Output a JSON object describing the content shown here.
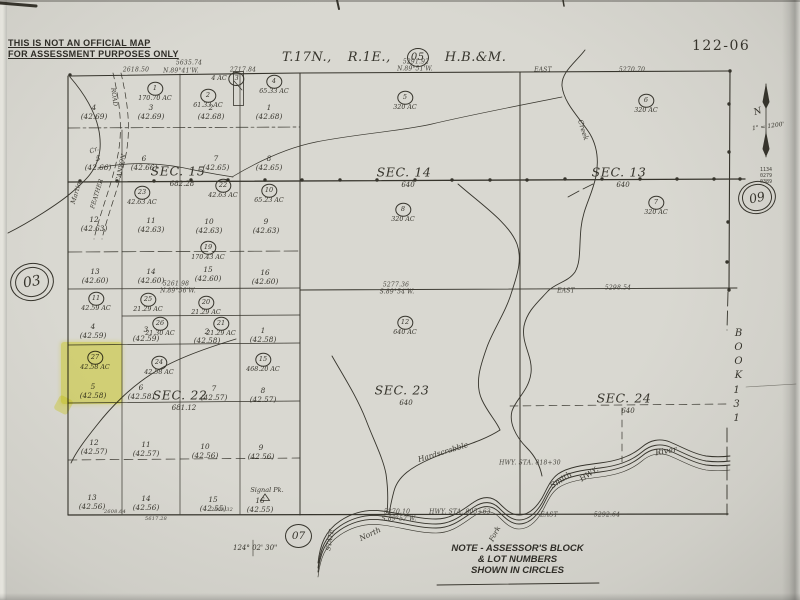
{
  "ink_color": "#36342c",
  "paper_color": "#d7d6cf",
  "highlight_color": "#f0ed3e",
  "page": {
    "map_number": "122-06",
    "disclaimer": [
      "THIS IS NOT AN OFFICIAL MAP",
      "FOR ASSESSMENT PURPOSES ONLY"
    ],
    "title": {
      "township": "T.17N.,",
      "range": "R.1E.,",
      "code": "05",
      "meridian": "H.B.&M."
    },
    "note": [
      "NOTE - ASSESSOR'S BLOCK",
      "& LOT NUMBERS",
      "SHOWN IN CIRCLES"
    ],
    "longitude": "124° 02' 30\"",
    "scale": "1\" = 1200'",
    "north": "N",
    "ref_left": "03",
    "ref_right": "09",
    "ref_bottom": "07",
    "stack": [
      "1134",
      "0279",
      "0389"
    ],
    "book_word": "BOOK",
    "book_number": "131"
  },
  "sections": [
    {
      "label": "SEC. 15",
      "sub": "682.28",
      "x": 178,
      "y": 171
    },
    {
      "label": "SEC. 14",
      "sub": "640",
      "x": 404,
      "y": 172
    },
    {
      "label": "SEC. 13",
      "sub": "640",
      "x": 619,
      "y": 172
    },
    {
      "label": "SEC. 22",
      "sub": "681.12",
      "x": 180,
      "y": 395
    },
    {
      "label": "SEC. 23",
      "sub": "640",
      "x": 402,
      "y": 390
    },
    {
      "label": "SEC. 24",
      "sub": "640",
      "x": 624,
      "y": 398
    }
  ],
  "lots": [
    {
      "n": "1",
      "ac": "170.70 AC",
      "x": 155,
      "y": 89
    },
    {
      "n": "2",
      "ac": "61.33 AC",
      "x": 208,
      "y": 96
    },
    {
      "n": "3",
      "ac": "4 AC",
      "x": 228,
      "y": 79,
      "side": true
    },
    {
      "n": "4",
      "ac": "65.33 AC",
      "x": 274,
      "y": 82
    },
    {
      "n": "5",
      "ac": "320 AC",
      "x": 405,
      "y": 98
    },
    {
      "n": "6",
      "ac": "320 AC",
      "x": 646,
      "y": 101
    },
    {
      "n": "7",
      "ac": "320 AC",
      "x": 656,
      "y": 203
    },
    {
      "n": "8",
      "ac": "320 AC",
      "x": 403,
      "y": 210
    },
    {
      "n": "23",
      "ac": "42.63 AC",
      "x": 142,
      "y": 193
    },
    {
      "n": "22",
      "ac": "42.63 AC",
      "x": 223,
      "y": 186
    },
    {
      "n": "10",
      "ac": "65.23 AC",
      "x": 269,
      "y": 191
    },
    {
      "n": "19",
      "ac": "170.43 AC",
      "x": 208,
      "y": 248
    },
    {
      "n": "11",
      "ac": "42.59 AC",
      "x": 96,
      "y": 299
    },
    {
      "n": "25",
      "ac": "21.29 AC",
      "x": 148,
      "y": 300
    },
    {
      "n": "20",
      "ac": "21.29 AC",
      "x": 206,
      "y": 303
    },
    {
      "n": "26",
      "ac": "21.30 AC",
      "x": 160,
      "y": 324
    },
    {
      "n": "21",
      "ac": "21.29 AC",
      "x": 221,
      "y": 324
    },
    {
      "n": "27",
      "ac": "42.58 AC",
      "x": 95,
      "y": 358
    },
    {
      "n": "24",
      "ac": "42.58 AC",
      "x": 159,
      "y": 363
    },
    {
      "n": "15",
      "ac": "468.20 AC",
      "x": 263,
      "y": 360
    },
    {
      "n": "12",
      "ac": "640 AC",
      "x": 405,
      "y": 323
    }
  ],
  "parcels": [
    {
      "n": "4",
      "v": "(42.69)",
      "x": 94,
      "y": 112
    },
    {
      "n": "3",
      "v": "(42.69)",
      "x": 151,
      "y": 112
    },
    {
      "n": "2",
      "v": "(42.68)",
      "x": 211,
      "y": 112
    },
    {
      "n": "1",
      "v": "(42.68)",
      "x": 269,
      "y": 112
    },
    {
      "n": "5",
      "v": "(42.66)",
      "x": 98,
      "y": 163
    },
    {
      "n": "6",
      "v": "(42.66)",
      "x": 144,
      "y": 163
    },
    {
      "n": "7",
      "v": "(42.65)",
      "x": 216,
      "y": 163
    },
    {
      "n": "8",
      "v": "(42.65)",
      "x": 269,
      "y": 163
    },
    {
      "n": "12",
      "v": "(42.63)",
      "x": 94,
      "y": 224
    },
    {
      "n": "11",
      "v": "(42.63)",
      "x": 151,
      "y": 225
    },
    {
      "n": "10",
      "v": "(42.63)",
      "x": 209,
      "y": 226
    },
    {
      "n": "9",
      "v": "(42.63)",
      "x": 266,
      "y": 226
    },
    {
      "n": "13",
      "v": "(42.60)",
      "x": 95,
      "y": 276
    },
    {
      "n": "14",
      "v": "(42.60)",
      "x": 151,
      "y": 276
    },
    {
      "n": "15",
      "v": "(42.60)",
      "x": 208,
      "y": 274
    },
    {
      "n": "16",
      "v": "(42.60)",
      "x": 265,
      "y": 277
    },
    {
      "n": "4",
      "v": "(42.59)",
      "x": 93,
      "y": 331
    },
    {
      "n": "3",
      "v": "(42.59)",
      "x": 146,
      "y": 334
    },
    {
      "n": "2",
      "v": "(42.58)",
      "x": 207,
      "y": 336
    },
    {
      "n": "1",
      "v": "(42.58)",
      "x": 263,
      "y": 335
    },
    {
      "n": "5",
      "v": "(42.58)",
      "x": 93,
      "y": 391
    },
    {
      "n": "6",
      "v": "(42.58)",
      "x": 141,
      "y": 392
    },
    {
      "n": "7",
      "v": "(42.57)",
      "x": 214,
      "y": 393
    },
    {
      "n": "8",
      "v": "(42.57)",
      "x": 263,
      "y": 395
    },
    {
      "n": "12",
      "v": "(42.57)",
      "x": 94,
      "y": 447
    },
    {
      "n": "11",
      "v": "(42.57)",
      "x": 146,
      "y": 449
    },
    {
      "n": "10",
      "v": "(42.56)",
      "x": 205,
      "y": 451
    },
    {
      "n": "9",
      "v": "(42.56)",
      "x": 261,
      "y": 452
    },
    {
      "n": "13",
      "v": "(42.56)",
      "x": 92,
      "y": 502
    },
    {
      "n": "14",
      "v": "(42.56)",
      "x": 146,
      "y": 503
    },
    {
      "n": "15",
      "v": "(42.55)",
      "x": 213,
      "y": 504
    },
    {
      "n": "16",
      "v": "(42.55)",
      "x": 260,
      "y": 505
    }
  ],
  "survey_text": [
    {
      "t": "2618.50",
      "x": 136,
      "y": 70
    },
    {
      "t": "5635.74",
      "x": 189,
      "y": 63
    },
    {
      "t": "N.89°41'W.",
      "x": 181,
      "y": 71
    },
    {
      "t": "2717.84",
      "x": 243,
      "y": 70
    },
    {
      "t": "5291.92",
      "x": 416,
      "y": 62
    },
    {
      "t": "N.89°51'W.",
      "x": 415,
      "y": 69
    },
    {
      "t": "EAST",
      "x": 543,
      "y": 70
    },
    {
      "t": "5270.70",
      "x": 632,
      "y": 70
    },
    {
      "t": "5261.98",
      "x": 176,
      "y": 284
    },
    {
      "t": "N.89°56'W.",
      "x": 178,
      "y": 291
    },
    {
      "t": "5277.36",
      "x": 396,
      "y": 285
    },
    {
      "t": "S.89°54'W.",
      "x": 397,
      "y": 292
    },
    {
      "t": "EAST",
      "x": 566,
      "y": 291
    },
    {
      "t": "5298.54",
      "x": 618,
      "y": 288
    },
    {
      "t": "5270.10",
      "x": 397,
      "y": 512
    },
    {
      "t": "S.89°52'W.",
      "x": 399,
      "y": 519
    },
    {
      "t": "HWY. STA. 805+63",
      "x": 460,
      "y": 512
    },
    {
      "t": "HWY. STA. 818+30",
      "x": 530,
      "y": 463
    },
    {
      "t": "EAST",
      "x": 549,
      "y": 515
    },
    {
      "t": "5292.64",
      "x": 607,
      "y": 515
    },
    {
      "t": "2608.64",
      "x": 115,
      "y": 512,
      "s": 5
    },
    {
      "t": "5617.28",
      "x": 156,
      "y": 519,
      "s": 5
    },
    {
      "t": "2608.32",
      "x": 222,
      "y": 510,
      "s": 5
    }
  ],
  "features": [
    {
      "t": "Creek",
      "x": 583,
      "y": 130,
      "r": 73,
      "s": 7
    },
    {
      "t": "ROAD",
      "x": 114,
      "y": 97,
      "r": 83,
      "s": 6
    },
    {
      "t": "CANYON",
      "x": 121,
      "y": 168,
      "r": -78,
      "s": 6
    },
    {
      "t": "Cr.",
      "x": 94,
      "y": 150,
      "r": -25,
      "s": 6.5
    },
    {
      "t": "Martin",
      "x": 76,
      "y": 193,
      "r": -73,
      "s": 6.5
    },
    {
      "t": "FEATHER",
      "x": 97,
      "y": 194,
      "r": -73,
      "s": 6
    },
    {
      "t": "Hardscrabble",
      "x": 443,
      "y": 452,
      "r": -17,
      "s": 7.5
    },
    {
      "t": "Smith",
      "x": 561,
      "y": 480,
      "r": -33,
      "s": 8
    },
    {
      "t": "HWY.",
      "x": 589,
      "y": 474,
      "r": -33,
      "s": 7.5
    },
    {
      "t": "River",
      "x": 666,
      "y": 451,
      "r": -10,
      "s": 8
    },
    {
      "t": "North",
      "x": 370,
      "y": 534,
      "r": -25,
      "s": 7.5
    },
    {
      "t": "Fork",
      "x": 495,
      "y": 534,
      "r": -62,
      "s": 7
    },
    {
      "t": "STATE",
      "x": 330,
      "y": 540,
      "r": -80,
      "s": 6.5
    },
    {
      "t": "Signal Pk.",
      "x": 267,
      "y": 490,
      "r": 0,
      "s": 6.5
    }
  ]
}
